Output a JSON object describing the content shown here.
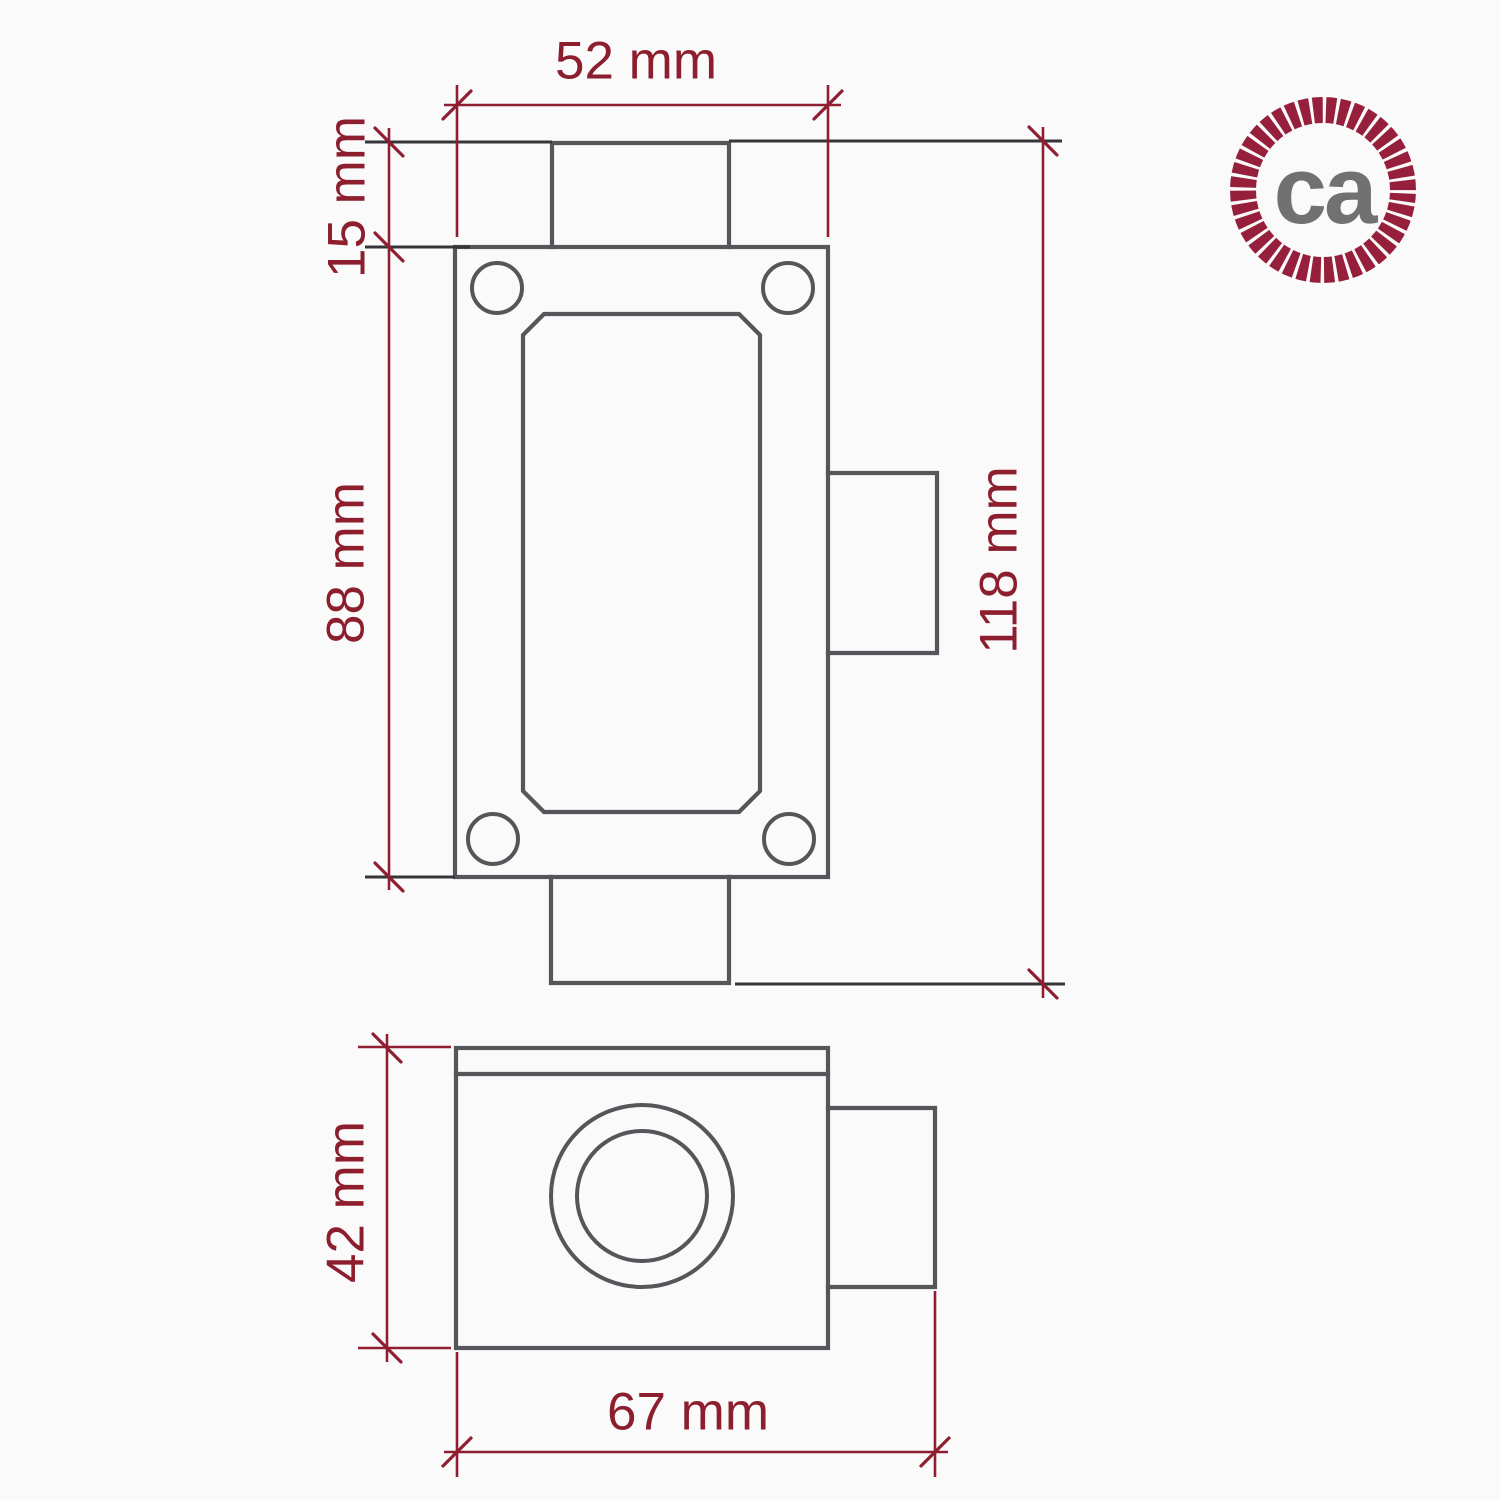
{
  "colors": {
    "bg": "#fafafa",
    "ink": "#55565a",
    "ext": "#35353a",
    "dim": "#8e1e30",
    "dim-text": "#8c1e2e",
    "logo-ring": "#96203c",
    "logo-text": "#717173"
  },
  "dimensions": {
    "body_width": {
      "label": "52 mm",
      "value_mm": 52
    },
    "stub_height": {
      "label": "15 mm",
      "value_mm": 15
    },
    "body_height": {
      "label": "88 mm",
      "value_mm": 88
    },
    "total_height": {
      "label": "118 mm",
      "value_mm": 118
    },
    "depth_height": {
      "label": "42 mm",
      "value_mm": 42
    },
    "total_depth": {
      "label": "67 mm",
      "value_mm": 67
    }
  },
  "logo": {
    "text": "ca"
  }
}
